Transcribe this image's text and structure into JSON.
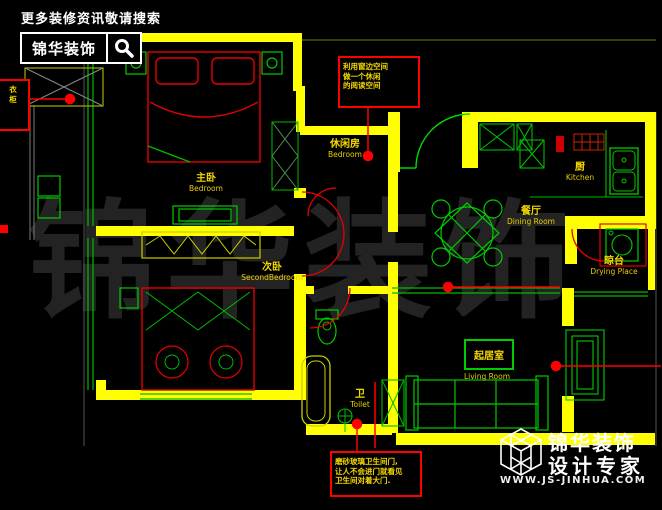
{
  "header": {
    "tagline": "更多装修资讯敬请搜索",
    "brand": "锦华装饰",
    "search_icon": "magnifier-icon"
  },
  "footer": {
    "brand": "锦华装饰",
    "tagline": "设计专家",
    "website": "WWW.JS-JINHUA.COM",
    "logo": "cube-logo"
  },
  "watermark": {
    "text": "锦华装饰"
  },
  "rooms": {
    "master": {
      "cn": "主卧",
      "en": "Bedroom"
    },
    "second": {
      "cn": "次卧",
      "en": "SecondBedroom"
    },
    "leisure": {
      "cn": "休闲房",
      "en": "Bedroom"
    },
    "kitchen": {
      "cn": "厨",
      "en": "Kitchen"
    },
    "dining": {
      "cn": "餐厅",
      "en": "Dining Room"
    },
    "living": {
      "cn": "起居室",
      "en": "Living Room"
    },
    "drying": {
      "cn": "晾台",
      "en": "Drying Place"
    },
    "toilet": {
      "cn": "卫",
      "en": "Toilet"
    }
  },
  "notes": {
    "reading": {
      "l1": "利用窗边空间",
      "l2": "做一个休闲",
      "l3": "的阅读空间"
    },
    "frosted": {
      "l1": "磨砂玻璃卫生间门,",
      "l2": "让人不会进门就看见",
      "l3": "卫生间对着大门."
    },
    "wardrobe": {
      "l1": "衣",
      "l2": "柜"
    }
  },
  "colors": {
    "background": "#000000",
    "wall": "#ffff00",
    "furniture": "#00cc00",
    "annotation": "#ff0000",
    "label": "#f5d800",
    "text": "#ffffff"
  }
}
